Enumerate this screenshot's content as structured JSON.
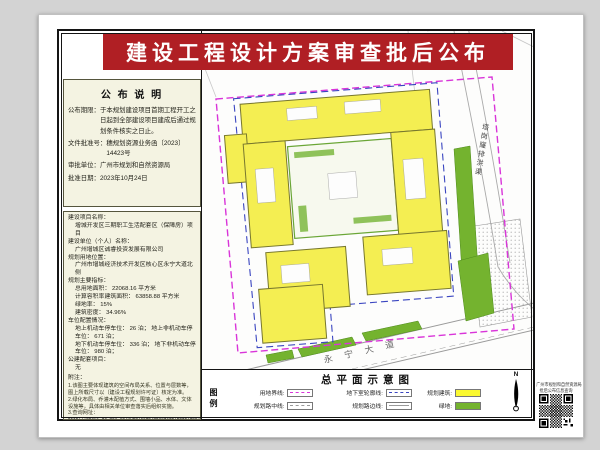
{
  "banner": {
    "title": "建设工程设计方案审查批后公布"
  },
  "colors": {
    "banner_red": "#b01f24",
    "panel_cream": "#f4f3e2",
    "building_yellow": "#f4ee52",
    "green_space": "#74b32f",
    "boundary_magenta": "#d935d9",
    "basement_blue": "#3a45c0"
  },
  "notice": {
    "title": "公 布 说 明",
    "items": [
      {
        "label": "公布期限：",
        "text": "于本规划建设项目首期工程开工之日起到全部建设项目建成后通过规划条件核实之日止。"
      },
      {
        "label": "文件批准号：",
        "text": "穗规划资源业务函〔2023〕14423号"
      },
      {
        "label": "审批单位：",
        "text": "广州市规划和自然资源局"
      },
      {
        "label": "批准日期：",
        "text": "2023年10月24日"
      }
    ]
  },
  "project": {
    "name_label": "建设项目名称：",
    "name": "增城开发区三期职工生活配套区（保障房）项目",
    "owner_label": "建设单位（个人）名称：",
    "owner": "广州增城区诚睿投资发展有限公司",
    "location_label": "规划用地位置：",
    "location": "广州市增城经济技术开发区核心区永宁大道北侧",
    "indicators_label": "规划主要指标：",
    "indicators": [
      "总用地面积： 22068.16 平方米",
      "计算容积率建筑面积： 63858.88 平方米",
      "绿地率： 15%",
      "建筑密度： 34.96%"
    ],
    "parking_label": "车位配置情况：",
    "parking": [
      "地上机动车停车位： 26 泊； 地上非机动车停车位： 671 泊；",
      "地下机动车停车位： 336 泊； 地下非机动车停车位： 980 泊；"
    ],
    "public_label": "公建配套项目：",
    "public_value": "无",
    "notes_label": "附注：",
    "notes": [
      "1.该图主要体现建筑的空间布局关系、位置与层数等，图上所载尺寸以〔建设工程规划许可证〕核定为准。",
      "2.绿化布局、乔灌木配植方式、围墙小品、水体、文体设施等，具体由相关单位审查落实后组织实施。",
      "3.查询网址："
    ],
    "url": "http://ghzyj.gz.gov.cn/ywpd/csgh/ghxkgsgb/phgb/gbt/"
  },
  "plan": {
    "title": "总平面示意图",
    "road_label": "永宁大道",
    "channel_label": "塔岗窿排洪渠",
    "compass": "N"
  },
  "legend": {
    "title": "图例",
    "items": [
      {
        "label": "用地界线:",
        "swatch": "magenta-dash-line"
      },
      {
        "label": "地下室轮廓线:",
        "swatch": "blue-dash-line"
      },
      {
        "label": "规划建筑:",
        "swatch": "yellow-fill"
      },
      {
        "label": "规划路中线:",
        "swatch": "gray-dashdot-line"
      },
      {
        "label": "规划路边线:",
        "swatch": "gray-solid-line"
      },
      {
        "label": "绿地:",
        "swatch": "green-fill"
      }
    ]
  },
  "qr": {
    "caption_line1": "广州市规划和自然资源局",
    "caption_line2": "批后公布信息查询"
  }
}
